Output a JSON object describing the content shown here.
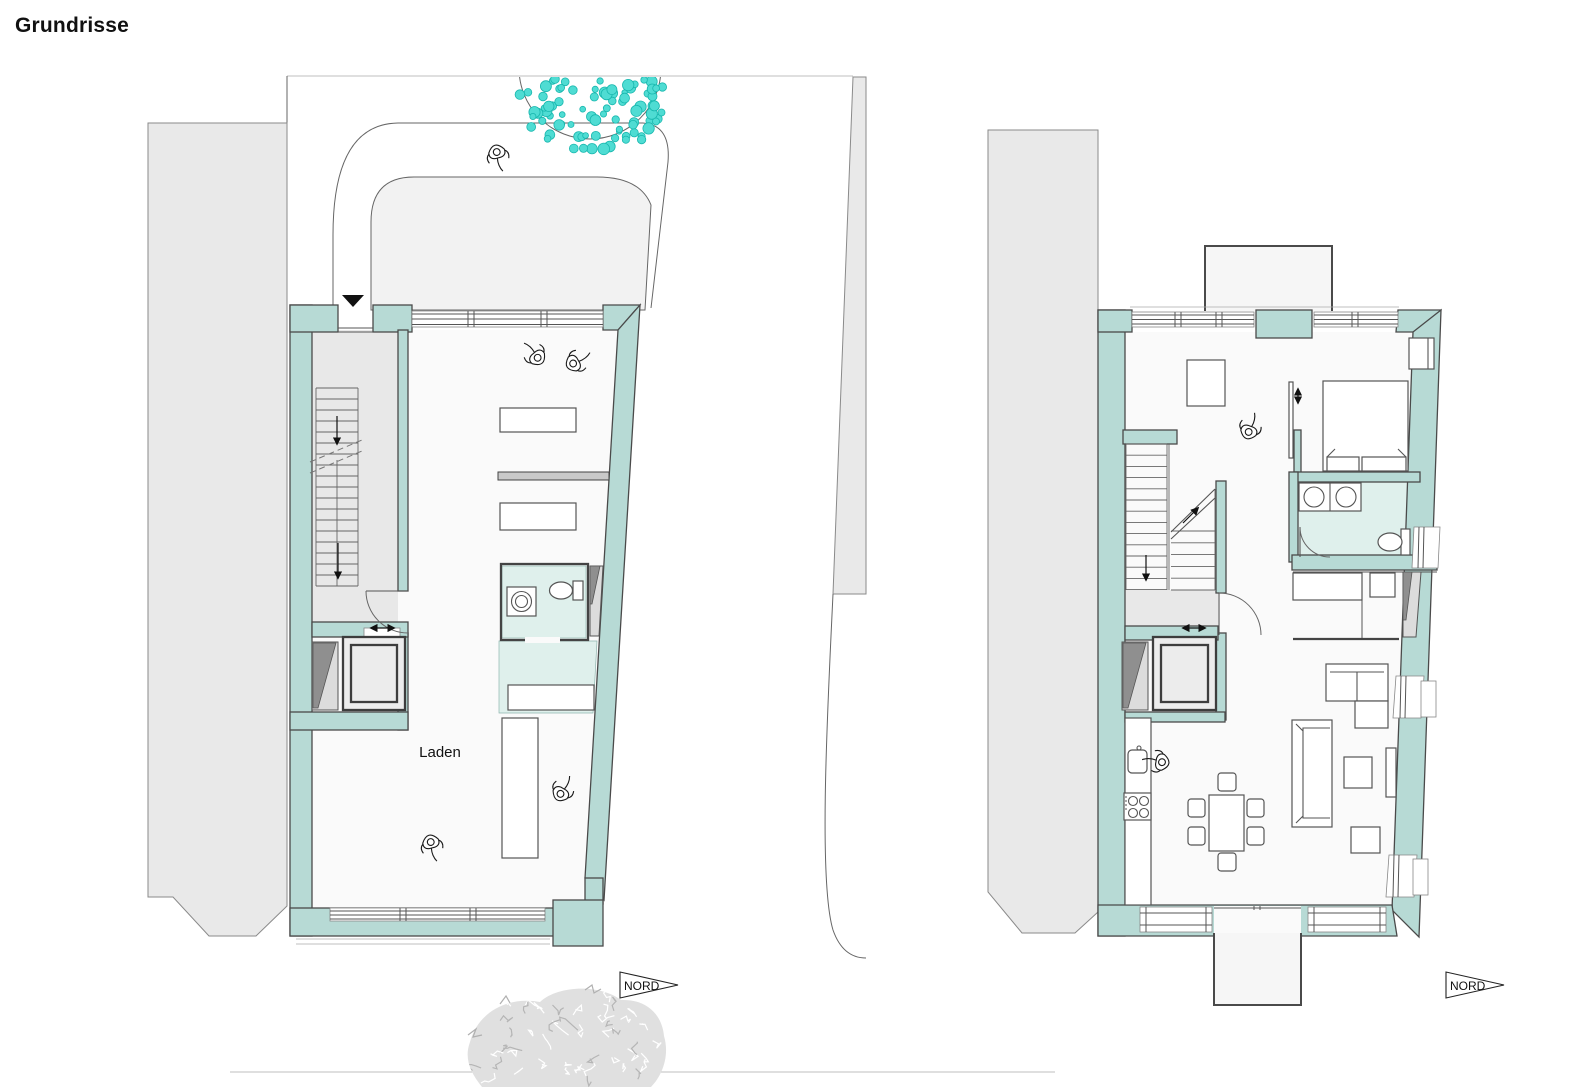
{
  "title": "Grundrisse",
  "plans": {
    "left": {
      "room_label": "Laden",
      "north_label": "NORD"
    },
    "right": {
      "north_label": "NORD"
    }
  },
  "colors": {
    "wall": "#b7dad5",
    "wall_outline": "#4a4a4a",
    "floor": "#fafafa",
    "floor_gray": "#e8e8e8",
    "floor_teal": "#dff0ec",
    "site_gray": "#e9e9e9",
    "forecourt": "#f2f2f2",
    "tree": "#4fdcd3",
    "tree_outline": "#18b7ae",
    "shrub": "#e0e0e0",
    "dark_fill": "#8f8f8f",
    "text": "#111111"
  }
}
